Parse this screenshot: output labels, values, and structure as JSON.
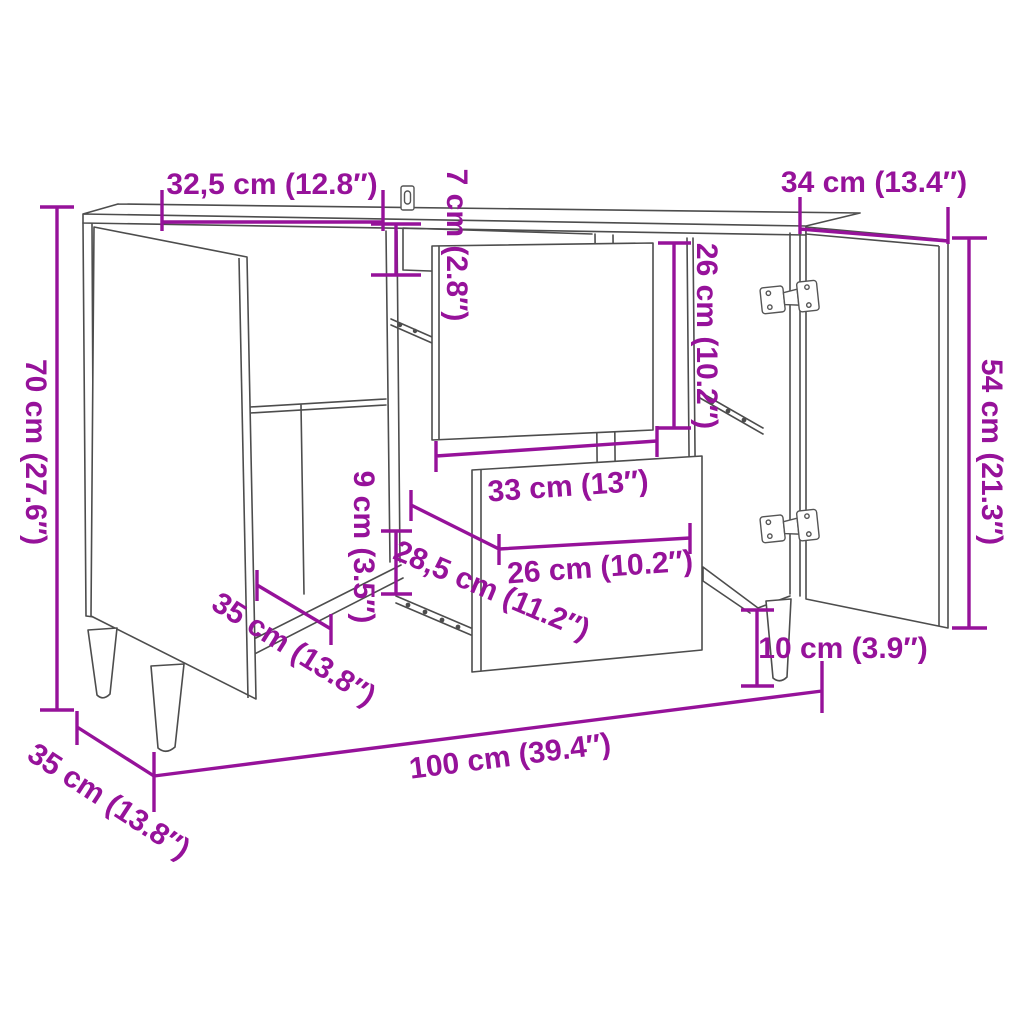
{
  "figure": {
    "type": "furniture-dimension-diagram",
    "subject": "sideboard with two open doors, pulled-out drawer and tapered legs"
  },
  "colors": {
    "dimension": "#96129A",
    "outline": "#4d4d4d",
    "background": "#ffffff"
  },
  "dims": {
    "top_section_width": "32,5 cm (12.8″)",
    "top_drawer_front_height": "7 cm (2.8″)",
    "door_width": "34 cm (13.4″)",
    "overall_height": "70 cm (27.6″)",
    "middle_drawer_front_height": "26 cm (10.2″)",
    "door_height": "54 cm (21.3″)",
    "drawer_box_height": "9 cm (3.5″)",
    "drawer_front_width": "33 cm (13″)",
    "drawer_box_depth": "28,5 cm (11.2″)",
    "drawer_box_width": "26 cm (10.2″)",
    "interior_depth": "35 cm (13.8″)",
    "leg_height": "10 cm (3.9″)",
    "overall_width": "100 cm (39.4″)",
    "overall_depth": "35 cm (13.8″)"
  }
}
